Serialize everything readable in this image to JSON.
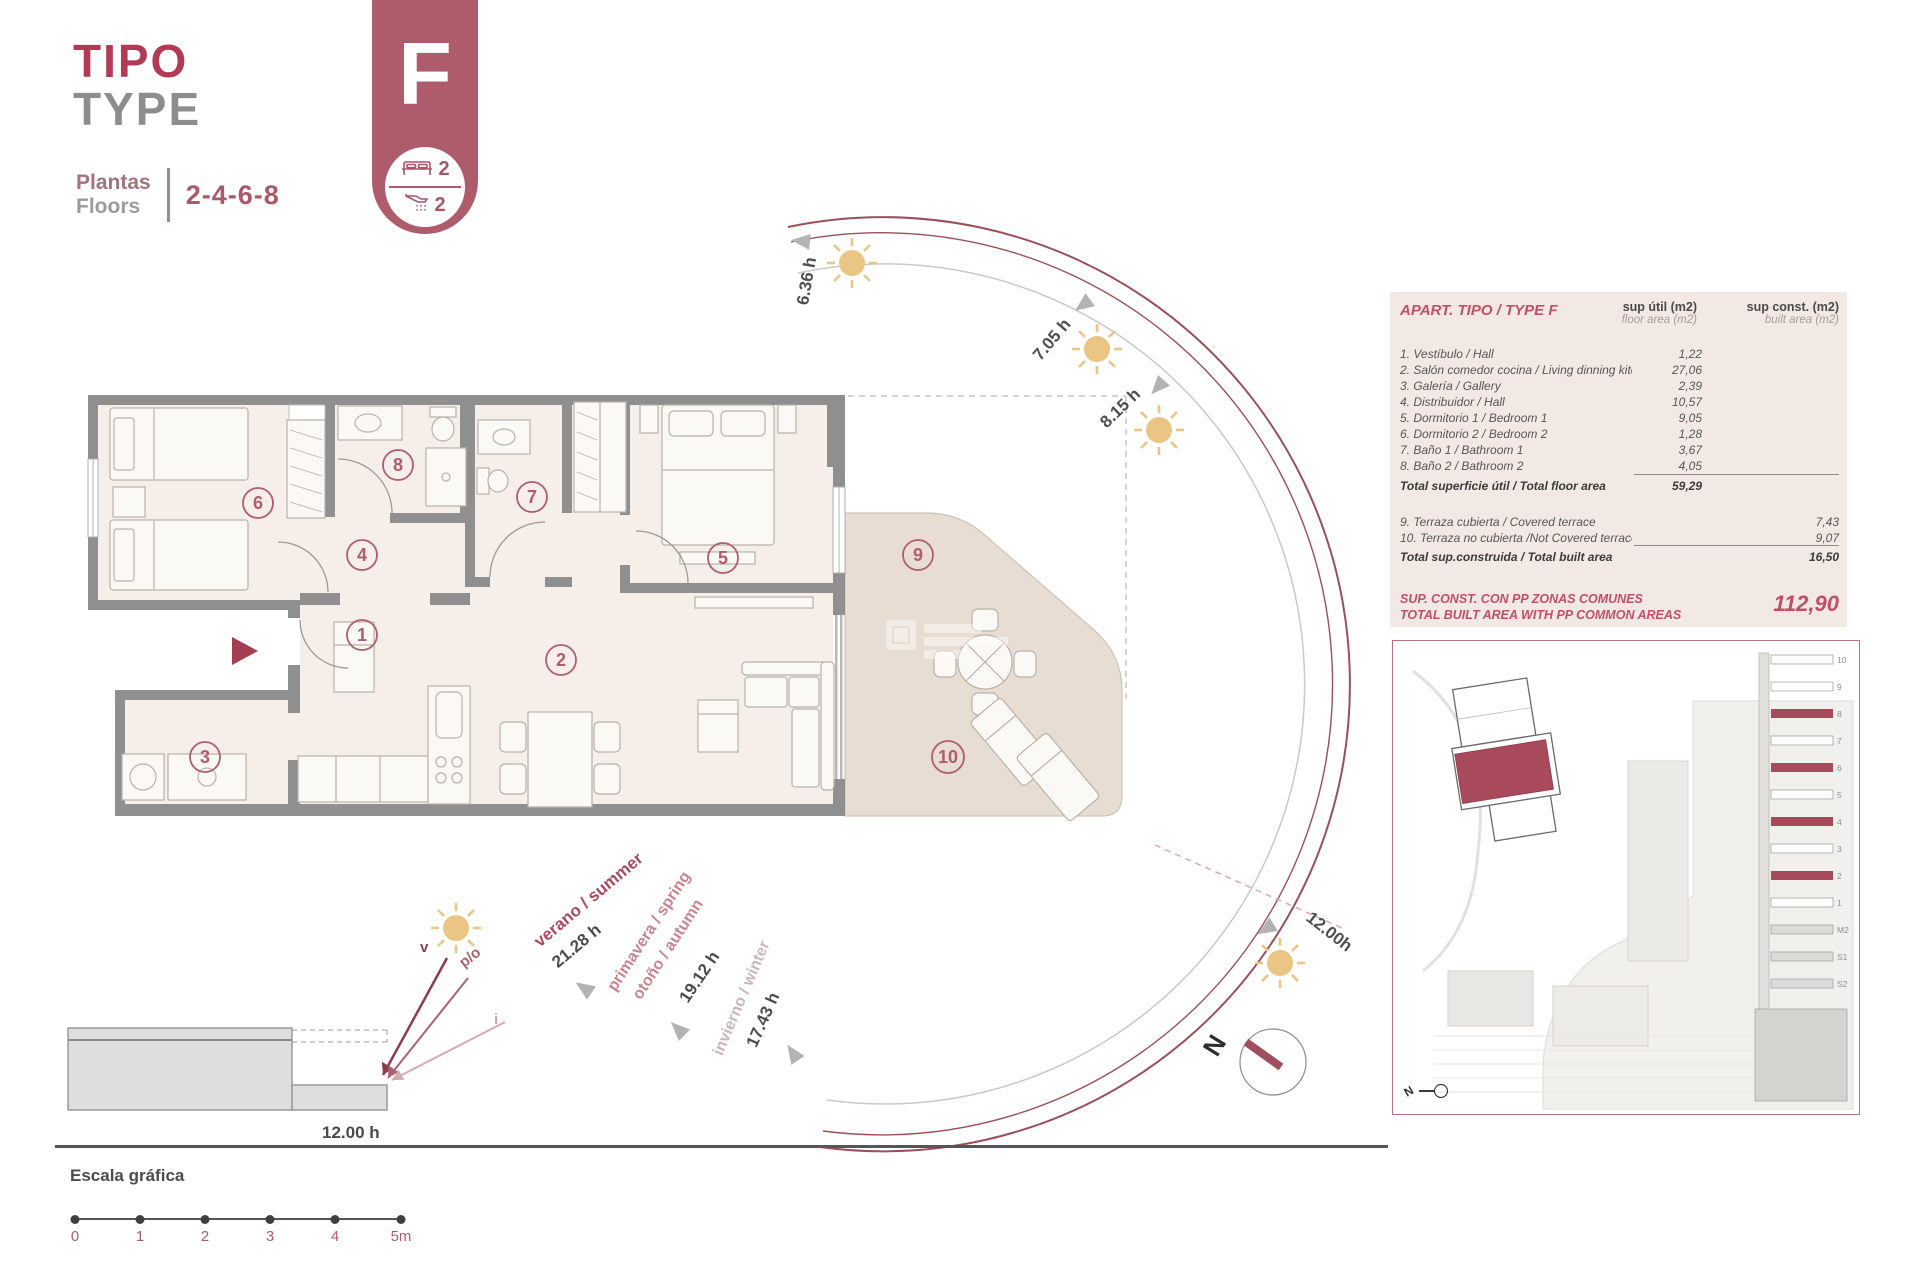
{
  "header": {
    "title_line1": "TIPO",
    "title_line2": "TYPE",
    "floors_label_line1": "Plantas",
    "floors_label_line2": "Floors",
    "floors_value": "2-4-6-8"
  },
  "badge": {
    "letter": "F",
    "bedrooms": "2",
    "bathrooms": "2"
  },
  "plan": {
    "rooms": [
      "1",
      "2",
      "3",
      "4",
      "5",
      "6",
      "7",
      "8",
      "9",
      "10"
    ]
  },
  "sun_path": {
    "hour_labels": [
      "6.36 h",
      "7.05 h",
      "8.15 h"
    ],
    "noon_label": "12.00h",
    "seasons": {
      "summer_name": "verano / summer",
      "summer_hours": "21.28 h",
      "spring_name": "primavera / spring",
      "autumn_name": "otoño / autumn",
      "spring_hours": "19.12 h",
      "winter_name": "invierno / winter",
      "winter_hours": "17.43 h"
    },
    "section": {
      "noon_label": "12.00 h",
      "ray_summer": "v",
      "ray_spring": "p/o",
      "ray_winter": "i"
    },
    "compass_label": "N"
  },
  "table": {
    "title": "APART. TIPO / TYPE F",
    "col_util_line1": "sup útil (m2)",
    "col_util_line2": "floor area (m2)",
    "col_const_line1": "sup const. (m2)",
    "col_const_line2": "built area (m2)",
    "rows": [
      {
        "label": "1. Vestíbulo / Hall",
        "util": "1,22"
      },
      {
        "label": "2. Salón comedor cocina / Living dinning kitchen",
        "util": "27,06"
      },
      {
        "label": "3. Galería / Gallery",
        "util": "2,39"
      },
      {
        "label": "4. Distribuidor / Hall",
        "util": "10,57"
      },
      {
        "label": "5. Dormitorio 1 / Bedroom 1",
        "util": "9,05"
      },
      {
        "label": "6. Dormitorio 2 / Bedroom 2",
        "util": "1,28"
      },
      {
        "label": "7. Baño 1 / Bathroom 1",
        "util": "3,67"
      },
      {
        "label": "8. Baño 2 / Bathroom 2",
        "util": "4,05"
      }
    ],
    "total_util_label": "Total superficie útil / Total floor area",
    "total_util_value": "59,29",
    "rows2": [
      {
        "label": "9. Terraza cubierta / Covered terrace",
        "const": "7,43"
      },
      {
        "label": "10. Terraza no cubierta /Not Covered terrace",
        "const": "9,07"
      }
    ],
    "total_const_label": "Total sup.construida / Total built area",
    "total_const_value": "16,50",
    "footer_line1": "SUP. CONST. CON PP ZONAS COMUNES",
    "footer_line2": "TOTAL BUILT AREA WITH PP COMMON AREAS",
    "footer_value": "112,90"
  },
  "scale_bar": {
    "title": "Escala gráfica",
    "ticks": [
      "0",
      "1",
      "2",
      "3",
      "4",
      "5m"
    ]
  },
  "inset": {
    "floor_labels": [
      "10",
      "9",
      "8",
      "7",
      "6",
      "5",
      "4",
      "3",
      "2",
      "1",
      "M2",
      "S1",
      "S2"
    ],
    "compass_label": "N"
  },
  "colors": {
    "brand_red": "#b13a54",
    "badge_mauve": "#ae5b6b",
    "arc_maroon": "#9b4f5c",
    "sun_yellow": "#eac583",
    "table_maroon": "#c34f67",
    "highlight_unit": "#a8495c"
  }
}
